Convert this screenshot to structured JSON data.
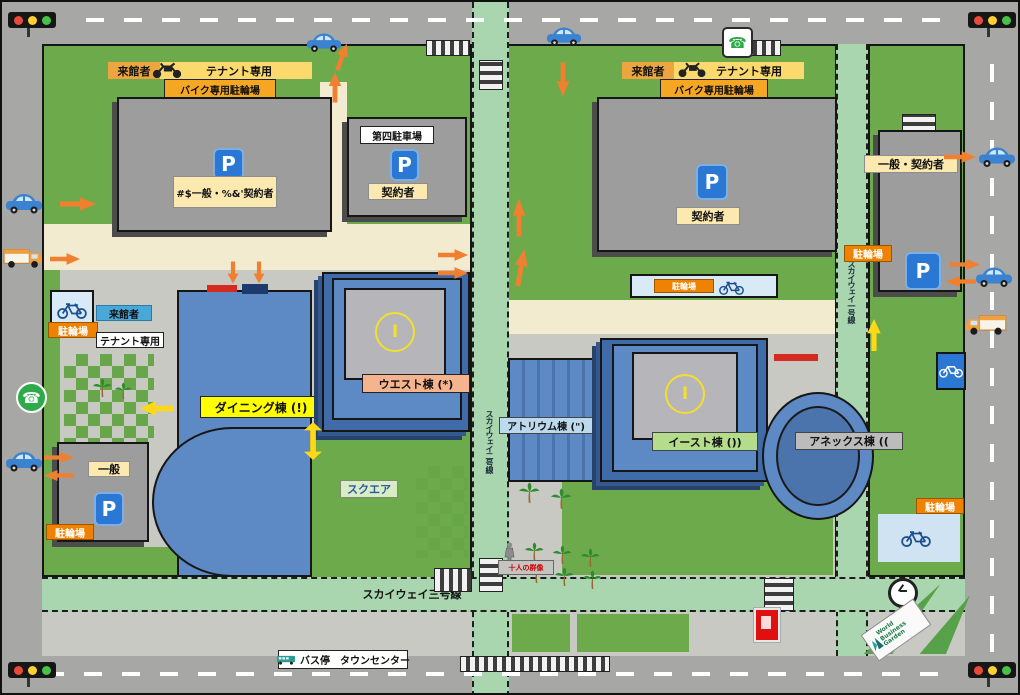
{
  "icons": {
    "parking_glyph": "P",
    "phone_glyph": "☎"
  },
  "entry_bands": {
    "west": {
      "visitor": "来館者",
      "tenant": "テナント専用",
      "bike_parking": "バイク専用駐輪場"
    },
    "east": {
      "visitor": "来館者",
      "tenant": "テナント専用",
      "bike_parking": "バイク専用駐輪場"
    }
  },
  "parking_lots": {
    "northwest": {
      "label": "#$一般・%&'契約者"
    },
    "fourth": {
      "name": "第四駐車場",
      "label": "契約者"
    },
    "northeast": {
      "label": "契約者"
    },
    "east": {
      "label": "一般・契約者",
      "bike": "駐輪場"
    },
    "southwest": {
      "label": "一般",
      "bike": "駐輪場"
    }
  },
  "west_gate": {
    "visitor": "来館者",
    "bike": "駐輪場",
    "tenant": "テナント専用"
  },
  "buildings": {
    "dining": {
      "label": "ダイニング棟 (!)"
    },
    "west": {
      "label": "ウエスト棟 (*)",
      "roof_glyph": "I"
    },
    "atrium": {
      "label": "アトリウム棟 (\")"
    },
    "east": {
      "label": "イースト棟 ())",
      "roof_glyph": "I"
    },
    "annex": {
      "label": "アネックス棟 (("
    },
    "square": {
      "label": "スクエア"
    }
  },
  "roads": {
    "skyway3": "スカイウェイ三号線",
    "skyway2": "スカイウェイ二号線",
    "skyway1": "スカイウェイ一号線"
  },
  "transit": {
    "bus_stop": "バス停　タウンセンター"
  },
  "bike_areas": {
    "center": "駐輪場",
    "southeast": "駐輪場"
  },
  "monument": {
    "label": "十人の群像"
  },
  "sign": {
    "line1": "World",
    "line2": "Business",
    "line3": "Garden"
  },
  "colors": {
    "accent_orange": "#f08300",
    "grass": "#6caa4c",
    "building_blue": "#5d89c4",
    "road_green": "#a9d6af"
  }
}
